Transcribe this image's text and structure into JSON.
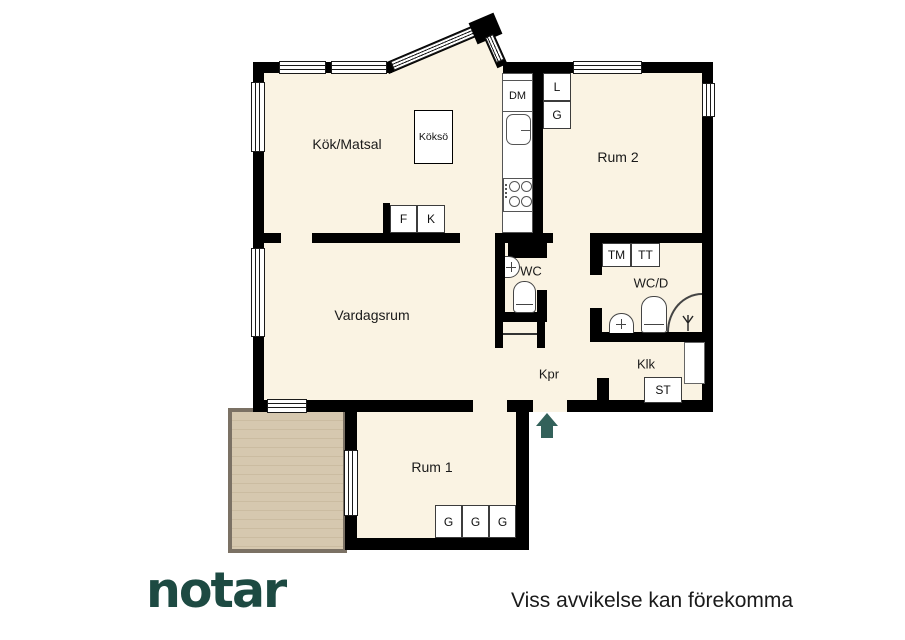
{
  "rooms": {
    "kitchen": "Kök/Matsal",
    "room2": "Rum 2",
    "living": "Vardagsrum",
    "wc": "WC",
    "wcd": "WC/D",
    "hall": "Kpr",
    "closet": "Klk",
    "room1": "Rum 1"
  },
  "units": {
    "dm": "DM",
    "linen": "L",
    "g_top": "G",
    "island": "Köksö",
    "fridge": "F",
    "freezer": "K",
    "tm": "TM",
    "tt": "TT",
    "st": "ST",
    "g1": "G",
    "g2": "G",
    "g3": "G"
  },
  "footer": {
    "logo": "notar",
    "disclaimer": "Viss avvikelse kan förekomma"
  },
  "icons": {
    "entrance": "entrance-arrow-up",
    "shower": "shower-head",
    "stove": "four-burners",
    "sink": "basin-with-cross",
    "toilet": "toilet-seat"
  },
  "colors": {
    "wall": "#000000",
    "floor": "#faf3e3",
    "balcony_deck": "#d6c8af",
    "balcony_border": "#7b7164",
    "logo_green": "#1d4a42",
    "arrow_green": "#33615a",
    "text": "#1a1a1a"
  }
}
